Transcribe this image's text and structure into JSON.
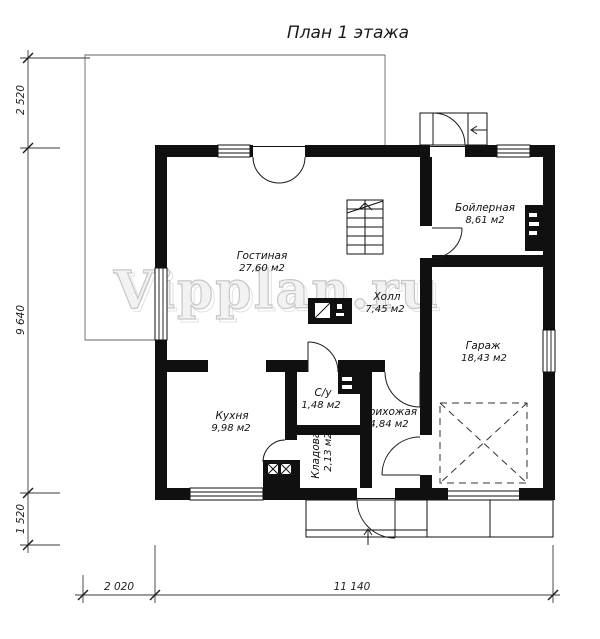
{
  "title": "План 1 этажа",
  "watermark": "Vipplan.ru",
  "rooms": {
    "living": {
      "name": "Гостиная",
      "area": "27,60 м2"
    },
    "hall": {
      "name": "Холл",
      "area": "7,45 м2"
    },
    "boiler": {
      "name": "Бойлерная",
      "area": "8,61 м2"
    },
    "garage": {
      "name": "Гараж",
      "area": "18,43 м2"
    },
    "kitchen": {
      "name": "Кухня",
      "area": "9,98 м2"
    },
    "wc": {
      "name": "С/у",
      "area": "1,48 м2"
    },
    "entry": {
      "name": "Прихожая",
      "area": "4,84 м2"
    },
    "storage": {
      "name": "Кладовая",
      "area": "2,13 м2"
    }
  },
  "dimensions": {
    "left_top": "2 520",
    "left_middle": "9 640",
    "left_bottom": "1 520",
    "bottom_left": "2 020",
    "bottom_right": "11 140"
  },
  "colors": {
    "wall": "#101010",
    "watermark_outline": "#c7c7c7",
    "dimension_line": "#3a3a3a"
  }
}
